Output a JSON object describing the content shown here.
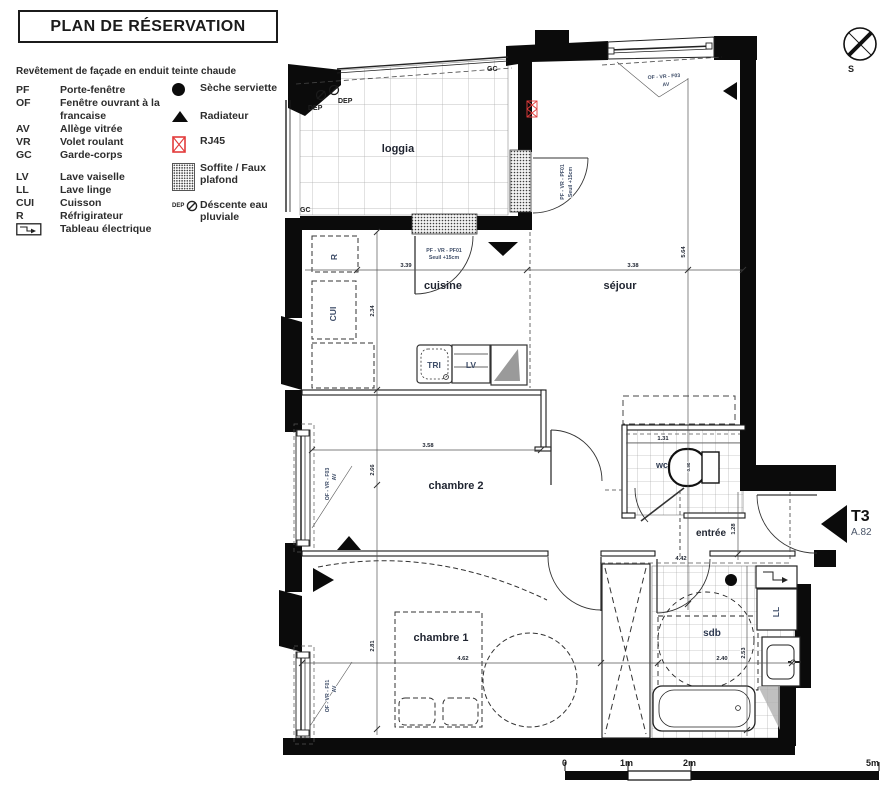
{
  "title": "PLAN DE RÉSERVATION",
  "facade_note": "Revêtement de façade en enduit teinte chaude",
  "legend": {
    "abbr_items": [
      {
        "abbr": "PF",
        "label": "Porte-fenêtre"
      },
      {
        "abbr": "OF",
        "label": "Fenêtre ouvrant à la francaise"
      },
      {
        "abbr": "AV",
        "label": "Allège vitrée"
      },
      {
        "abbr": "VR",
        "label": "Volet roulant"
      },
      {
        "abbr": "GC",
        "label": "Garde-corps"
      },
      {
        "abbr": "LV",
        "label": "Lave vaiselle"
      },
      {
        "abbr": "LL",
        "label": "Lave linge"
      },
      {
        "abbr": "CUI",
        "label": "Cuisson"
      },
      {
        "abbr": "R",
        "label": "Réfrigirateur"
      }
    ],
    "tableau_label": "Tableau électrique",
    "symbol_items": [
      {
        "icon": "seche-serviette-icon",
        "label": "Sèche serviette"
      },
      {
        "icon": "radiateur-icon",
        "label": "Radiateur"
      },
      {
        "icon": "rj45-icon",
        "label": "RJ45"
      },
      {
        "icon": "soffite-icon",
        "label": "Soffite / Faux plafond"
      },
      {
        "icon": "dep-icon",
        "prefix": "DEP",
        "label": "Déscente eau pluviale"
      }
    ]
  },
  "compass": {
    "south_label": "S"
  },
  "unit": {
    "type_label": "T3",
    "lot_label": "A.82"
  },
  "rooms": {
    "loggia": "loggia",
    "cuisine": "cuisine",
    "sejour": "séjour",
    "chambre2": "chambre 2",
    "wc": "wc",
    "entree": "entrée",
    "chambre1": "chambre 1",
    "sdb": "sdb"
  },
  "fixtures": {
    "tri": "TRI",
    "lv": "LV",
    "ll": "LL",
    "r": "R",
    "cui": "CUI"
  },
  "plan_labels": {
    "gc_top": "GC",
    "gc_bottom": "GC",
    "dep1": "DEP",
    "dep2": "DEP"
  },
  "windows": {
    "sejour_top": "OF - VR - F03",
    "sejour_top_av": "AV",
    "sejour_west": "PF - VR - PF01",
    "sejour_west_seuil": "Seuil +15cm",
    "cuisine_door": "PF - VR - PF01",
    "cuisine_door_seuil": "Seuil +15cm",
    "chambre2_win": "OF - VR - F03",
    "chambre2_av": "AV",
    "chambre1_win": "OF - VR - F01",
    "chambre1_av": "AV"
  },
  "dims": {
    "cuisine_w": "3.39",
    "sejour_w": "3.38",
    "column_top": "2.34",
    "sejour_h": "5.64",
    "chambre2_w": "3.58",
    "chambre2_h": "2.66",
    "wc_w": "1.31",
    "wc_d": "0.90",
    "entree_h": "1.28",
    "entree_w": "4.42",
    "chambre1_w": "4.62",
    "chambre1_h": "2.81",
    "sdb_w": "2.40",
    "sdb_h": "2.53"
  },
  "scale_bar": {
    "t0": "0",
    "t1": "1m",
    "t2": "2m",
    "t5": "5m"
  },
  "colors": {
    "wall": "#0b0b0b",
    "rj45_red": "#e23b3b",
    "label_blue": "#3e4d68",
    "dim_text": "#1e2430"
  }
}
